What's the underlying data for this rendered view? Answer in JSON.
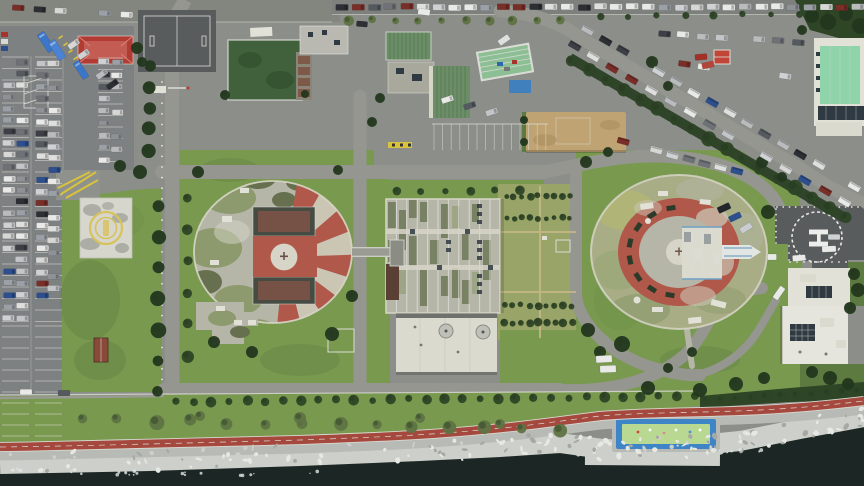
{
  "meta": {
    "title": "Aerial top-down drone photograph of a seaside hospital campus",
    "description": "Two circular ward buildings with red-and-white radial striped roofs, a central ribbed block, a square landing pad with yellow emblem, an H helipad, large parking lots with cars, a tree-lined avenue, coastal promenade with red bike path, rocky breakwater and sea"
  },
  "helipad": {
    "marking": "H"
  },
  "palette": {
    "asphalt": "#8b8e89",
    "asphalt_dark": "#6a6d6a",
    "road": "#94968f",
    "parking": "#7e8182",
    "court": "#585c5c",
    "grass": "#79994f",
    "grass_bright": "#6f9248",
    "grass_weed": "#98a468",
    "grass_dark": "#5d7a40",
    "hedge": "#2e4526",
    "tree_olive": "#5f7343",
    "tree_dark": "#23371d",
    "concrete": "#b5b6a8",
    "concrete_light": "#d7d5c8",
    "moss": "#8d9a6e",
    "moss_dark": "#66704f",
    "stripe_red": "#b0584a",
    "stripe_white": "#cbc5b4",
    "red_roof": "#b23c33",
    "red_roof_light": "#d8837a",
    "green_roof": "#6b8e67",
    "green_roof_dark": "#567653",
    "mint_roof": "#8fd3ab",
    "dark_green_roof": "#41603c",
    "warehouse_green": "#8cbf94",
    "tan": "#bfa372",
    "white_bldg": "#e2e1d8",
    "annex": "#dadace",
    "panel_dark": "#2f3a42",
    "blue": "#3b76c9",
    "pool_blue": "#3e85c8",
    "pool_green": "#b9d892",
    "path_red": "#a5493e",
    "path_edge": "#d8d8d2",
    "promenade": "#b8bbb5",
    "rocks": "#cdd0ca",
    "rock_light": "#e7e8e3",
    "rock_dark": "#a6a9a3",
    "sea": "#1c2725",
    "foam": "#dfe5e2",
    "line_white": "#dcdcd6",
    "line_yellow": "#d9c33a",
    "shed": "#8a4a3a",
    "brown": "#5a4034",
    "emblem_gold": "#d8c25e",
    "heli_mark": "#ededе9"
  },
  "generated": {
    "car_colors": [
      "#e9eae8",
      "#dfe0de",
      "#cfd2d4",
      "#c3c6c9",
      "#b9bbbd",
      "#9aa0a5",
      "#2c2f34",
      "#555a61",
      "#8e9296",
      "#7a2e28",
      "#2d4f8e",
      "#3c3f45",
      "#d7d8d6",
      "#6e7277"
    ],
    "car_rows": [
      {
        "x1": 9,
        "y1": 62,
        "x2": 9,
        "y2": 318,
        "n": 23,
        "w": 12,
        "h": 5.6,
        "rot": 0,
        "gap": 0.1
      },
      {
        "x1": 22,
        "y1": 62,
        "x2": 22,
        "y2": 318,
        "n": 23,
        "w": 12,
        "h": 5.6,
        "rot": 0,
        "gap": 0.12
      },
      {
        "x1": 42,
        "y1": 64,
        "x2": 42,
        "y2": 318,
        "n": 23,
        "w": 12,
        "h": 5.6,
        "rot": 0,
        "gap": 0.2
      },
      {
        "x1": 54,
        "y1": 64,
        "x2": 54,
        "y2": 300,
        "n": 21,
        "w": 12,
        "h": 5.6,
        "rot": 0,
        "gap": 0.35
      },
      {
        "x1": 104,
        "y1": 62,
        "x2": 104,
        "y2": 160,
        "n": 9,
        "w": 11,
        "h": 5.4,
        "rot": 0,
        "gap": 0.2
      },
      {
        "x1": 117,
        "y1": 62,
        "x2": 117,
        "y2": 150,
        "n": 8,
        "w": 11,
        "h": 5.4,
        "rot": 0,
        "gap": 0.3
      },
      {
        "x1": 74,
        "y1": 44,
        "x2": 112,
        "y2": 84,
        "n": 5,
        "w": 12,
        "h": 5.6,
        "rot": -35,
        "gap": 0.15
      },
      {
        "x1": 342,
        "y1": 7,
        "x2": 858,
        "y2": 7,
        "n": 33,
        "w": 12.5,
        "h": 6,
        "rot": 0,
        "gap": 0.06
      },
      {
        "x1": 18,
        "y1": 8,
        "x2": 126,
        "y2": 14,
        "n": 6,
        "w": 12,
        "h": 5.6,
        "rot": 3,
        "gap": 0.3
      },
      {
        "x1": 588,
        "y1": 30,
        "x2": 854,
        "y2": 186,
        "n": 16,
        "w": 6.2,
        "h": 12.5,
        "rot": -60,
        "gap": 0.12
      },
      {
        "x1": 574,
        "y1": 46,
        "x2": 844,
        "y2": 202,
        "n": 15,
        "w": 6.2,
        "h": 12.5,
        "rot": -60,
        "gap": 0.15
      },
      {
        "x1": 624,
        "y1": 142,
        "x2": 770,
        "y2": 180,
        "n": 10,
        "w": 6,
        "h": 12,
        "rot": -75,
        "gap": 0.2
      },
      {
        "x1": 664,
        "y1": 34,
        "x2": 798,
        "y2": 42,
        "n": 8,
        "w": 12,
        "h": 5.8,
        "rot": 4,
        "gap": 0.2
      },
      {
        "x1": 684,
        "y1": 64,
        "x2": 786,
        "y2": 76,
        "n": 6,
        "w": 12,
        "h": 5.8,
        "rot": 8,
        "gap": 0.25
      },
      {
        "x1": 448,
        "y1": 100,
        "x2": 492,
        "y2": 112,
        "n": 3,
        "w": 12,
        "h": 5.6,
        "rot": -18,
        "gap": 0
      }
    ],
    "vehicles": [
      {
        "x": 46,
        "y": 42,
        "w": 8,
        "h": 21,
        "rot": -33,
        "c": "#3b76c9",
        "t": "bus"
      },
      {
        "x": 57,
        "y": 50,
        "w": 8,
        "h": 21,
        "rot": -33,
        "c": "#4a82d4",
        "t": "bus"
      },
      {
        "x": 81,
        "y": 70,
        "w": 7,
        "h": 19,
        "rot": -33,
        "c": "#3b76c9",
        "t": "bus"
      },
      {
        "x": 701,
        "y": 57,
        "w": 12,
        "h": 6,
        "rot": -5,
        "c": "#a33027",
        "t": "car"
      },
      {
        "x": 708,
        "y": 65,
        "w": 12,
        "h": 6,
        "rot": -12,
        "c": "#b5443a",
        "t": "car"
      },
      {
        "x": 724,
        "y": 208,
        "w": 13,
        "h": 6.5,
        "rot": -25,
        "c": "#23262b",
        "t": "car"
      },
      {
        "x": 735,
        "y": 217,
        "w": 12.5,
        "h": 6,
        "rot": -25,
        "c": "#2d4f8e",
        "t": "car"
      },
      {
        "x": 746,
        "y": 228,
        "w": 12.5,
        "h": 6,
        "rot": -32,
        "c": "#c9ccd1",
        "t": "car"
      },
      {
        "x": 799,
        "y": 258,
        "w": 13,
        "h": 6,
        "rot": -4,
        "c": "#e9eae8",
        "t": "car"
      },
      {
        "x": 829,
        "y": 249,
        "w": 14,
        "h": 6,
        "rot": -2,
        "c": "#e9eae8",
        "t": "car"
      },
      {
        "x": 834,
        "y": 237,
        "w": 12,
        "h": 5.5,
        "rot": 0,
        "c": "#cfd2d4",
        "t": "car"
      },
      {
        "x": 772,
        "y": 257,
        "w": 9,
        "h": 6,
        "rot": 0,
        "c": "#e9eae8",
        "t": "car"
      },
      {
        "x": 604,
        "y": 359,
        "w": 16,
        "h": 7,
        "rot": -3,
        "c": "#e9eae8",
        "t": "van"
      },
      {
        "x": 608,
        "y": 369,
        "w": 16,
        "h": 7,
        "rot": -2,
        "c": "#e9eae8",
        "t": "van"
      },
      {
        "x": 779,
        "y": 293,
        "w": 14,
        "h": 6,
        "rot": -55,
        "c": "#e9eae8",
        "t": "van"
      },
      {
        "x": 424,
        "y": 12,
        "w": 12,
        "h": 6,
        "rot": 8,
        "c": "#e9eae8",
        "t": "car"
      },
      {
        "x": 504,
        "y": 40,
        "w": 12,
        "h": 6,
        "rot": -35,
        "c": "#dfe0de",
        "t": "car"
      },
      {
        "x": 362,
        "y": 24,
        "w": 11,
        "h": 5.5,
        "rot": 5,
        "c": "#2c2f34",
        "t": "car"
      },
      {
        "x": 26,
        "y": 392,
        "w": 12,
        "h": 5.5,
        "rot": 0,
        "c": "#e9eae8",
        "t": "car"
      },
      {
        "x": 64,
        "y": 393,
        "w": 12,
        "h": 5.5,
        "rot": 0,
        "c": "#555a61",
        "t": "car"
      }
    ],
    "stall_groups": [
      {
        "x": 2,
        "len": 27,
        "y1": 57,
        "y2": 322,
        "step": 11.5,
        "dir": "h"
      },
      {
        "x": 35,
        "len": 27,
        "y1": 57,
        "y2": 322,
        "step": 11.5,
        "dir": "h"
      },
      {
        "x": 2,
        "len": 27,
        "y1": 326,
        "y2": 438,
        "step": 11,
        "dir": "h"
      },
      {
        "x": 35,
        "len": 27,
        "y1": 326,
        "y2": 438,
        "step": 11,
        "dir": "h"
      },
      {
        "x": 98,
        "len": 25,
        "y1": 58,
        "y2": 165,
        "step": 11.5,
        "dir": "h"
      },
      {
        "x": 434,
        "x2": 546,
        "y": 124,
        "len": 26,
        "step": 8.6,
        "dir": "v"
      }
    ],
    "tree_rows": [
      {
        "x1": 572,
        "y1": 60,
        "x2": 846,
        "y2": 218,
        "n": 17,
        "r": 6,
        "c": "hedge"
      },
      {
        "x1": 176,
        "y1": 402,
        "x2": 694,
        "y2": 396,
        "n": 30,
        "r": 4.2,
        "c": "hedge"
      },
      {
        "x1": 706,
        "y1": 400,
        "x2": 858,
        "y2": 392,
        "n": 11,
        "r": 4.4,
        "c": "hedge"
      },
      {
        "x1": 348,
        "y1": 20,
        "x2": 560,
        "y2": 21,
        "n": 10,
        "r": 4,
        "c": "tree_olive"
      },
      {
        "x1": 600,
        "y1": 17,
        "x2": 828,
        "y2": 13,
        "n": 9,
        "r": 3.4,
        "c": "hedge"
      },
      {
        "x1": 506,
        "y1": 196,
        "x2": 570,
        "y2": 196,
        "n": 9,
        "r": 3,
        "c": "hedge"
      },
      {
        "x1": 506,
        "y1": 218,
        "x2": 570,
        "y2": 218,
        "n": 9,
        "r": 3,
        "c": "hedge"
      },
      {
        "x1": 504,
        "y1": 305,
        "x2": 572,
        "y2": 306,
        "n": 9,
        "r": 3.4,
        "c": "hedge"
      },
      {
        "x1": 504,
        "y1": 323,
        "x2": 572,
        "y2": 323,
        "n": 9,
        "r": 3.4,
        "c": "hedge"
      },
      {
        "x1": 150,
        "y1": 66,
        "x2": 148,
        "y2": 150,
        "n": 5,
        "r": 6,
        "c": "tree_dark"
      },
      {
        "x1": 158,
        "y1": 206,
        "x2": 158,
        "y2": 392,
        "n": 7,
        "r": 7,
        "c": "tree_dark"
      },
      {
        "x1": 188,
        "y1": 198,
        "x2": 188,
        "y2": 356,
        "n": 6,
        "r": 5,
        "c": "hedge"
      },
      {
        "x1": 396,
        "y1": 191,
        "x2": 520,
        "y2": 191,
        "n": 6,
        "r": 4,
        "c": "hedge"
      },
      {
        "x1": 82,
        "y1": 420,
        "x2": 560,
        "y2": 428,
        "n": 14,
        "r": 6,
        "c": "tree_olive",
        "jit": 6
      }
    ],
    "trees": [
      [
        198,
        172,
        6
      ],
      [
        338,
        170,
        5
      ],
      [
        352,
        296,
        6
      ],
      [
        332,
        334,
        7
      ],
      [
        252,
        352,
        6
      ],
      [
        214,
        342,
        6
      ],
      [
        137,
        48,
        6
      ],
      [
        142,
        62,
        5
      ],
      [
        225,
        95,
        5
      ],
      [
        305,
        94,
        4
      ],
      [
        586,
        162,
        6
      ],
      [
        608,
        152,
        5
      ],
      [
        762,
        162,
        6
      ],
      [
        782,
        177,
        5
      ],
      [
        588,
        330,
        7
      ],
      [
        600,
        352,
        6
      ],
      [
        622,
        344,
        8
      ],
      [
        648,
        388,
        7
      ],
      [
        700,
        390,
        7
      ],
      [
        736,
        384,
        7
      ],
      [
        764,
        378,
        6
      ],
      [
        692,
        352,
        5
      ],
      [
        668,
        368,
        5
      ],
      [
        768,
        212,
        7
      ],
      [
        854,
        274,
        6
      ],
      [
        858,
        290,
        7
      ],
      [
        850,
        308,
        6
      ],
      [
        812,
        372,
        6
      ],
      [
        830,
        378,
        7
      ],
      [
        848,
        384,
        6
      ],
      [
        812,
        16,
        7
      ],
      [
        828,
        22,
        8
      ],
      [
        846,
        14,
        7
      ],
      [
        860,
        26,
        8
      ],
      [
        802,
        30,
        5
      ],
      [
        524,
        120,
        4
      ],
      [
        524,
        142,
        4
      ],
      [
        380,
        98,
        5
      ],
      [
        372,
        122,
        5
      ],
      [
        652,
        62,
        6
      ],
      [
        668,
        86,
        5
      ],
      [
        120,
        166,
        6
      ],
      [
        140,
        172,
        7
      ],
      [
        200,
        416,
        5,
        "tree_olive"
      ],
      [
        300,
        418,
        6,
        "tree_olive"
      ],
      [
        420,
        418,
        5,
        "tree_olive"
      ],
      [
        500,
        424,
        5,
        "tree_olive"
      ]
    ],
    "posts": [
      {
        "x1": 777,
        "y1": 207,
        "x2": 858,
        "y2": 207,
        "n": 14
      },
      {
        "x1": 776,
        "y1": 209,
        "x2": 776,
        "y2": 243,
        "n": 7
      },
      {
        "x1": 789,
        "y1": 246,
        "x2": 789,
        "y2": 260,
        "n": 3
      },
      {
        "x1": 790,
        "y1": 262,
        "x2": 846,
        "y2": 262,
        "n": 9
      },
      {
        "x1": 162,
        "y1": 82,
        "x2": 162,
        "y2": 390,
        "n": 30
      }
    ],
    "rocks": {
      "pts": [
        [
          0,
          464
        ],
        [
          150,
          461
        ],
        [
          300,
          456
        ],
        [
          420,
          451
        ],
        [
          500,
          447
        ],
        [
          560,
          443
        ],
        [
          610,
          450
        ],
        [
          680,
          447
        ],
        [
          740,
          441
        ],
        [
          800,
          429
        ],
        [
          864,
          417
        ]
      ],
      "half": 11,
      "n": 160
    },
    "foam": {
      "pts": [
        [
          8,
          470
        ],
        [
          70,
          472
        ],
        [
          130,
          473
        ],
        [
          190,
          474
        ],
        [
          250,
          475
        ],
        [
          320,
          472
        ],
        [
          726,
          452
        ],
        [
          750,
          450
        ],
        [
          774,
          444
        ]
      ],
      "n": 40
    }
  }
}
